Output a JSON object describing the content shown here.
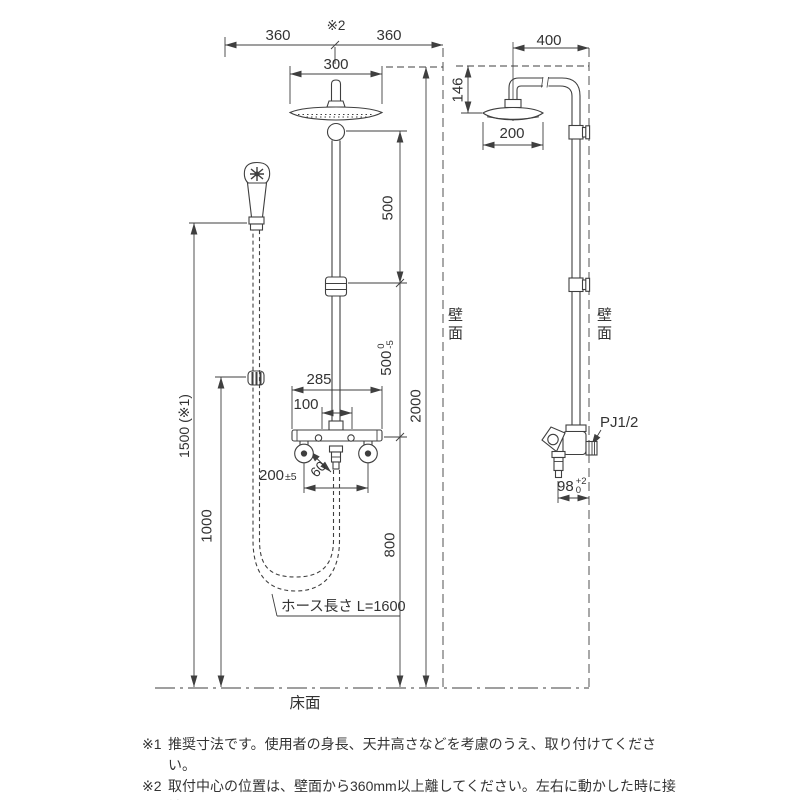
{
  "front_view": {
    "dim_360_left": "360",
    "center_mark": "※2",
    "dim_360_right": "360",
    "dim_300": "300",
    "dim_500_upper": "500",
    "dim_500_lower": "500",
    "dim_500_lower_tol_upper": "0",
    "dim_500_lower_tol_lower": "-5",
    "dim_2000": "2000",
    "dim_800": "800",
    "dim_285": "285",
    "dim_100": "100",
    "dim_200": "200",
    "dim_200_tol": "±5",
    "dim_60": "60",
    "dim_1500": "1500 (※1)",
    "dim_1000": "1000",
    "hose_length_label": "ホース長さ L=1600",
    "wall_label": "壁面",
    "floor_label": "床面"
  },
  "side_view": {
    "dim_400": "400",
    "dim_146": "146",
    "dim_200": "200",
    "dim_98": "98",
    "dim_98_tol_upper": "+2",
    "dim_98_tol_lower": "0",
    "thread_label": "PJ1/2",
    "wall_label": "壁面"
  },
  "notes": [
    {
      "marker": "※1",
      "text": "推奨寸法です。使用者の身長、天井高さなどを考慮のうえ、取り付けてください。"
    },
    {
      "marker": "※2",
      "text": "取付中心の位置は、壁面から360mm以上離してください。左右に動かした時に接触"
    },
    {
      "marker": "",
      "text": "することがあります。"
    }
  ],
  "colors": {
    "line": "#3f3f3f",
    "text": "#333333",
    "background": "#ffffff"
  }
}
